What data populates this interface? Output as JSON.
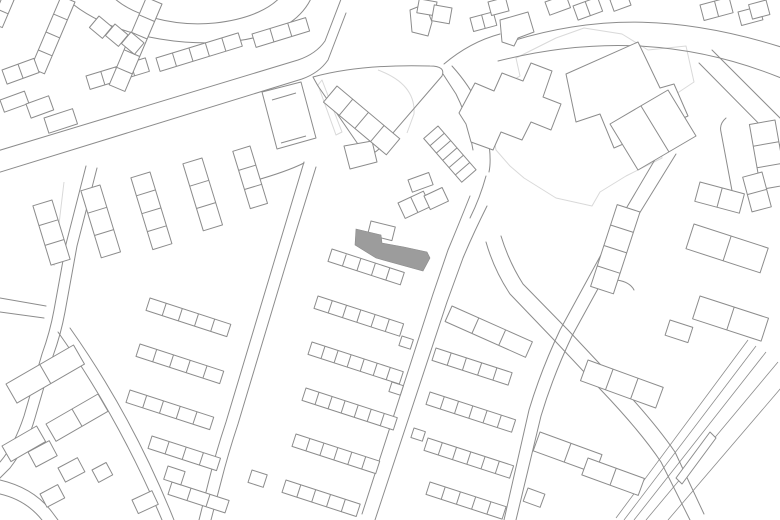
{
  "map": {
    "canvas": {
      "width": 780,
      "height": 520,
      "background": "#ffffff"
    },
    "colors": {
      "line": "#8c8c8c",
      "light_line": "#d9d9d9",
      "highlight_fill": "#9c9c9c",
      "highlight_stroke": "#8a8a8a"
    },
    "highlight_building": {
      "label": "site-building-highlighted",
      "path": "M356,229 L381,235 L382,243 L404,247 L427,252 L430,258 L423,271 L376,258 L355,245 Z"
    },
    "roads": [
      "M-6,152 L298,60 Q316,54 325,41 L343,-6",
      "M-6,174 L302,79 Q319,73 328,60 L346,13",
      "M110,-6 C130,16 175,27 215,23 C250,19 272,8 283,-6",
      "M62,-6 C95,30 170,49 236,41 C276,36 303,20 313,-6",
      "M512,41 C600,14 682,16 781,47",
      "M498,61 C598,36 690,41 781,78",
      "M712,50 L781,119",
      "M699,63 L781,146",
      "M444,64 Q470,42 500,34",
      "M452,66 Q470,86 479,106 L487,132 Q492,158 489,172",
      "M443,74 L456,94 Q465,112 469,129 L473,150",
      "M486,176 Q480,198 470,218",
      "M470,196 Q458,226 448,250 L433,294 L362,514",
      "M487,206 Q473,234 463,258 L447,302 L375,520",
      "M486,242 Q494,270 510,294 L556,342 L601,390 Q641,432 661,462 L690,520",
      "M501,236 Q509,262 523,284 L568,330 L613,378 Q653,420 675,452 L704,514",
      "M663,146 L627,207 L560,330 Q541,370 529,410 L504,520",
      "M676,154 L639,214 L572,336 Q553,376 541,416 L516,520",
      "M304,162 L274,262 L226,422 Q216,452 209,480 L199,520",
      "M316,167 L286,264 L238,424 Q228,454 221,482 L211,520",
      "M250,182 Q286,172 304,163",
      "M86,166 L66,244 L54,310 Q50,332 42,354 L24,416 Q14,446 0,462",
      "M97,168 L77,246 L65,312 Q61,334 53,356 L35,418 Q27,446 10,468 L0,478",
      "M0,298 L46,306",
      "M0,312 L44,318",
      "M58,332 C92,380 130,444 162,520",
      "M70,328 C104,376 142,440 174,520",
      "M0,480 Q34,488 52,512 L58,520",
      "M0,494 Q26,500 42,520",
      "M313,77 Q360,64 430,66 Q446,66 442,76 L380,148 Q368,160 362,150 L318,86 Q314,79 313,77 Z",
      "M726,118 Q719,124 721,132 L733,196",
      "M617,280 Q630,282 634,290"
    ],
    "blocks": [
      "M262,92 L301,82 L316,138 L277,149 Z M272,100 L296,93 M281,143 L306,136",
      "M459,113 L475,83 L494,91 L502,73 L523,81 L531,63 L552,71 L543,97 L561,104 L551,130 L531,122 L522,140 L501,132 L493,150 L471,142 L466,124 Z",
      "M566,74 L638,42 L660,88 L674,84 L688,116 L614,148 L600,114 L576,122 Z M638,42 L660,88",
      "M610,124 L668,90 L696,136 L638,170 Z M641,106 L669,152",
      "M410,10 L425,4 L432,22 L428,36 L412,32 Z",
      "M500,20 L528,12 L534,32 L518,38 L514,46 L502,42 Z",
      "M344,146 L372,141 L377,162 L350,169 Z",
      "M716,438 L682,484 L676,478 L710,432 Z"
    ],
    "terraces": [
      {
        "x": 332,
        "y": 249,
        "len": 76,
        "w": 13,
        "ang": 18,
        "cells": 5
      },
      {
        "x": 318,
        "y": 296,
        "len": 90,
        "w": 13,
        "ang": 18,
        "cells": 6
      },
      {
        "x": 312,
        "y": 342,
        "len": 96,
        "w": 13,
        "ang": 18,
        "cells": 7
      },
      {
        "x": 306,
        "y": 388,
        "len": 96,
        "w": 13,
        "ang": 18,
        "cells": 7
      },
      {
        "x": 296,
        "y": 434,
        "len": 88,
        "w": 13,
        "ang": 18,
        "cells": 6
      },
      {
        "x": 286,
        "y": 480,
        "len": 78,
        "w": 13,
        "ang": 18,
        "cells": 5
      },
      {
        "x": 452,
        "y": 306,
        "len": 88,
        "w": 17,
        "ang": 24,
        "cells": 3
      },
      {
        "x": 436,
        "y": 348,
        "len": 80,
        "w": 13,
        "ang": 18,
        "cells": 5
      },
      {
        "x": 430,
        "y": 392,
        "len": 90,
        "w": 13,
        "ang": 18,
        "cells": 6
      },
      {
        "x": 428,
        "y": 438,
        "len": 90,
        "w": 13,
        "ang": 18,
        "cells": 6
      },
      {
        "x": 430,
        "y": 482,
        "len": 80,
        "w": 13,
        "ang": 18,
        "cells": 5
      },
      {
        "x": 150,
        "y": 298,
        "len": 85,
        "w": 13,
        "ang": 18,
        "cells": 5
      },
      {
        "x": 140,
        "y": 344,
        "len": 88,
        "w": 13,
        "ang": 18,
        "cells": 5
      },
      {
        "x": 130,
        "y": 390,
        "len": 88,
        "w": 13,
        "ang": 18,
        "cells": 5
      },
      {
        "x": 152,
        "y": 436,
        "len": 72,
        "w": 13,
        "ang": 18,
        "cells": 4
      },
      {
        "x": 172,
        "y": 482,
        "len": 60,
        "w": 13,
        "ang": 18,
        "cells": 3
      },
      {
        "x": 52,
        "y": 200,
        "len": 62,
        "w": 20,
        "ang": 73,
        "cells": 3
      },
      {
        "x": 100,
        "y": 185,
        "len": 70,
        "w": 20,
        "ang": 73,
        "cells": 3
      },
      {
        "x": 150,
        "y": 172,
        "len": 75,
        "w": 20,
        "ang": 73,
        "cells": 4
      },
      {
        "x": 202,
        "y": 158,
        "len": 70,
        "w": 20,
        "ang": 73,
        "cells": 3
      },
      {
        "x": 250,
        "y": 146,
        "len": 60,
        "w": 18,
        "ang": 73,
        "cells": 3
      },
      {
        "x": 86,
        "y": 76,
        "len": 62,
        "w": 14,
        "ang": -17,
        "cells": 4
      },
      {
        "x": 156,
        "y": 58,
        "len": 86,
        "w": 14,
        "ang": -17,
        "cells": 5
      },
      {
        "x": 252,
        "y": 34,
        "len": 56,
        "w": 14,
        "ang": -17,
        "cells": 3
      },
      {
        "x": 75,
        "y": 2,
        "len": 78,
        "w": 15,
        "ang": 113,
        "cells": 4
      },
      {
        "x": 162,
        "y": 4,
        "len": 95,
        "w": 17,
        "ang": 113,
        "cells": 5
      },
      {
        "x": 775,
        "y": 120,
        "len": 66,
        "w": 26,
        "ang": 80,
        "cells": 3
      },
      {
        "x": 640,
        "y": 212,
        "len": 86,
        "w": 24,
        "ang": 108,
        "cells": 4
      },
      {
        "x": 694,
        "y": 224,
        "len": 78,
        "w": 26,
        "ang": 18,
        "cells": 2
      },
      {
        "x": 700,
        "y": 296,
        "len": 72,
        "w": 24,
        "ang": 18,
        "cells": 2
      },
      {
        "x": 588,
        "y": 360,
        "len": 80,
        "w": 22,
        "ang": 20,
        "cells": 3
      },
      {
        "x": 540,
        "y": 432,
        "len": 66,
        "w": 20,
        "ang": 20,
        "cells": 2
      },
      {
        "x": 588,
        "y": 458,
        "len": 60,
        "w": 18,
        "ang": 20,
        "cells": 2
      },
      {
        "x": 6,
        "y": 384,
        "len": 78,
        "w": 22,
        "ang": -30,
        "cells": 2
      },
      {
        "x": 46,
        "y": 424,
        "len": 60,
        "w": 20,
        "ang": -30,
        "cells": 2
      },
      {
        "x": 2,
        "y": 446,
        "len": 40,
        "w": 18,
        "ang": -30,
        "cells": 1
      },
      {
        "x": 337,
        "y": 86,
        "len": 82,
        "w": 21,
        "ang": 40,
        "cells": 4
      },
      {
        "x": 438,
        "y": 126,
        "len": 58,
        "w": 19,
        "ang": 49,
        "cells": 6
      },
      {
        "x": 762,
        "y": 172,
        "len": 36,
        "w": 20,
        "ang": 75,
        "cells": 2
      },
      {
        "x": 14,
        "y": 0,
        "len": 30,
        "w": 12,
        "ang": 113,
        "cells": 2
      }
    ],
    "houses": [
      {
        "x": 99,
        "y": 16,
        "len": 17,
        "w": 15,
        "ang": 40,
        "cells": 1
      },
      {
        "x": 115,
        "y": 24,
        "len": 17,
        "w": 15,
        "ang": 40,
        "cells": 1
      },
      {
        "x": 131,
        "y": 32,
        "len": 17,
        "w": 15,
        "ang": 40,
        "cells": 1
      },
      {
        "x": 2,
        "y": 70,
        "len": 34,
        "w": 15,
        "ang": -20,
        "cells": 2
      },
      {
        "x": 0,
        "y": 100,
        "len": 26,
        "w": 13,
        "ang": -20,
        "cells": 1
      },
      {
        "x": 26,
        "y": 104,
        "len": 24,
        "w": 15,
        "ang": -20,
        "cells": 1
      },
      {
        "x": 44,
        "y": 118,
        "len": 30,
        "w": 16,
        "ang": -18,
        "cells": 1
      },
      {
        "x": 371,
        "y": 221,
        "len": 25,
        "w": 14,
        "ang": 14,
        "cells": 1
      },
      {
        "x": 398,
        "y": 203,
        "len": 28,
        "w": 17,
        "ang": -25,
        "cells": 2
      },
      {
        "x": 424,
        "y": 196,
        "len": 20,
        "w": 15,
        "ang": -25,
        "cells": 1
      },
      {
        "x": 408,
        "y": 180,
        "len": 22,
        "w": 13,
        "ang": -20,
        "cells": 1
      },
      {
        "x": 437,
        "y": 2,
        "len": 14,
        "w": 18,
        "ang": 100,
        "cells": 1
      },
      {
        "x": 452,
        "y": 8,
        "len": 16,
        "w": 18,
        "ang": 100,
        "cells": 1
      },
      {
        "x": 470,
        "y": 18,
        "len": 24,
        "w": 14,
        "ang": -15,
        "cells": 2
      },
      {
        "x": 488,
        "y": 2,
        "len": 18,
        "w": 14,
        "ang": -15,
        "cells": 1
      },
      {
        "x": 545,
        "y": 2,
        "len": 22,
        "w": 14,
        "ang": -20,
        "cells": 1
      },
      {
        "x": 573,
        "y": 6,
        "len": 26,
        "w": 15,
        "ang": -20,
        "cells": 2
      },
      {
        "x": 610,
        "y": 0,
        "len": 18,
        "w": 12,
        "ang": -20,
        "cells": 1
      },
      {
        "x": 700,
        "y": 5,
        "len": 30,
        "w": 16,
        "ang": -15,
        "cells": 2
      },
      {
        "x": 738,
        "y": 12,
        "len": 22,
        "w": 14,
        "ang": -15,
        "cells": 1
      },
      {
        "x": 766,
        "y": 0,
        "len": 15,
        "w": 18,
        "ang": 75,
        "cells": 1
      },
      {
        "x": 28,
        "y": 452,
        "len": 24,
        "w": 17,
        "ang": -28,
        "cells": 1
      },
      {
        "x": 58,
        "y": 468,
        "len": 22,
        "w": 16,
        "ang": -28,
        "cells": 1
      },
      {
        "x": 40,
        "y": 494,
        "len": 20,
        "w": 15,
        "ang": -28,
        "cells": 1
      },
      {
        "x": 92,
        "y": 470,
        "len": 16,
        "w": 14,
        "ang": -28,
        "cells": 1
      },
      {
        "x": 132,
        "y": 500,
        "len": 22,
        "w": 15,
        "ang": -25,
        "cells": 1
      },
      {
        "x": 252,
        "y": 470,
        "len": 16,
        "w": 13,
        "ang": 18,
        "cells": 1
      },
      {
        "x": 168,
        "y": 466,
        "len": 18,
        "w": 14,
        "ang": 18,
        "cells": 1
      },
      {
        "x": 402,
        "y": 336,
        "len": 12,
        "w": 10,
        "ang": 18,
        "cells": 1
      },
      {
        "x": 392,
        "y": 382,
        "len": 12,
        "w": 10,
        "ang": 18,
        "cells": 1
      },
      {
        "x": 414,
        "y": 428,
        "len": 12,
        "w": 10,
        "ang": 18,
        "cells": 1
      },
      {
        "x": 670,
        "y": 320,
        "len": 24,
        "w": 16,
        "ang": 18,
        "cells": 1
      },
      {
        "x": 528,
        "y": 488,
        "len": 18,
        "w": 14,
        "ang": 20,
        "cells": 1
      },
      {
        "x": 700,
        "y": 182,
        "len": 46,
        "w": 20,
        "ang": 15,
        "cells": 2
      }
    ],
    "light_shapes": [
      "M496,150 L490,118 L508,106 L503,86 L520,76 L516,58 L556,38 L584,28 L622,34 L648,50 L686,46 L694,82 L676,94 L680,122 L658,134 L662,158 L626,176 L600,192 L592,206 L556,198 L524,178 L510,166 Z",
      "M378,70 Q416,84 414,114 L407,133",
      "M322,80 L342,132 L336,135 L318,85 Z",
      "M64,182 L54,266"
    ],
    "rail": [
      "M748,340 L616,518",
      "M756,346 L624,520",
      "M766,352 L634,520",
      "M778,362 L646,520",
      "M781,388 L668,520"
    ]
  }
}
